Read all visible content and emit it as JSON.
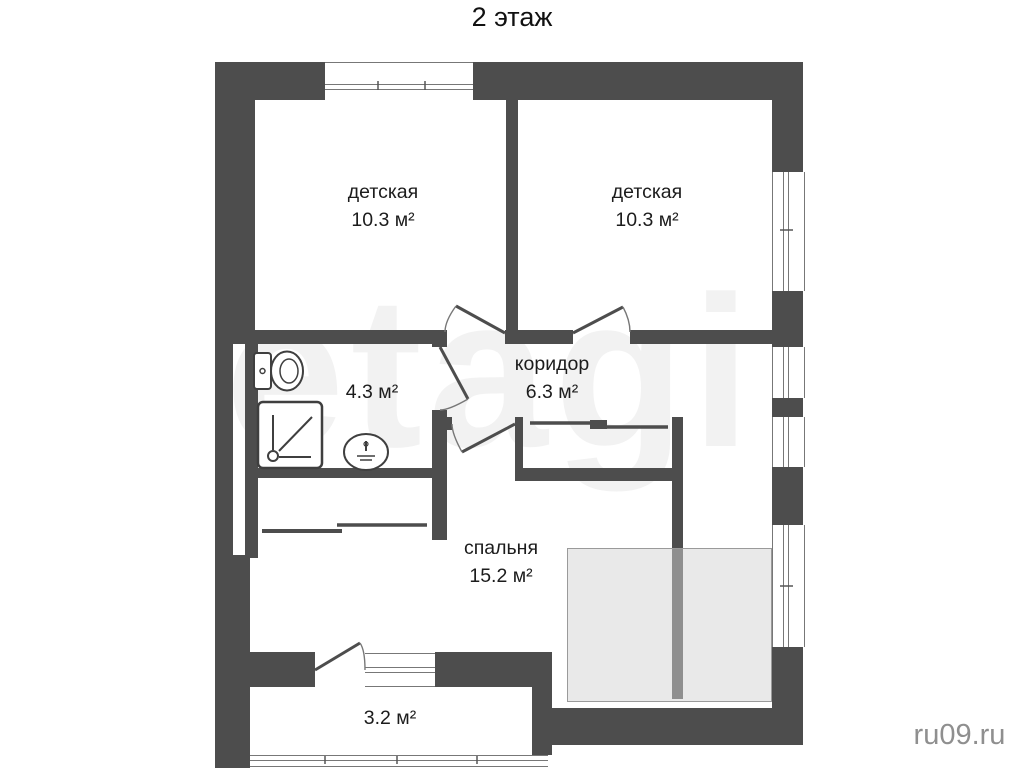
{
  "title": "2 этаж",
  "rooms": {
    "nursery_left": {
      "name": "детская",
      "area": "10.3 м²"
    },
    "nursery_right": {
      "name": "детская",
      "area": "10.3 м²"
    },
    "corridor": {
      "name": "коридор",
      "area": "6.3 м²"
    },
    "bathroom": {
      "area": "4.3 м²"
    },
    "bedroom": {
      "name": "спальня",
      "area": "15.2 м²"
    },
    "balcony": {
      "area": "3.2 м²"
    }
  },
  "fixtures": [
    "toilet-icon",
    "shower-icon",
    "sink-icon"
  ],
  "watermarks": {
    "site": "ru09.ru",
    "background": "etagi"
  },
  "colors": {
    "wall": "#4d4d4d",
    "terrace_fill": "#e9e9e9",
    "terrace_divider": "#8f8f8f",
    "window_line": "#777777",
    "label_text": "#1c1c1c",
    "site_watermark": "#8f8f8f"
  }
}
